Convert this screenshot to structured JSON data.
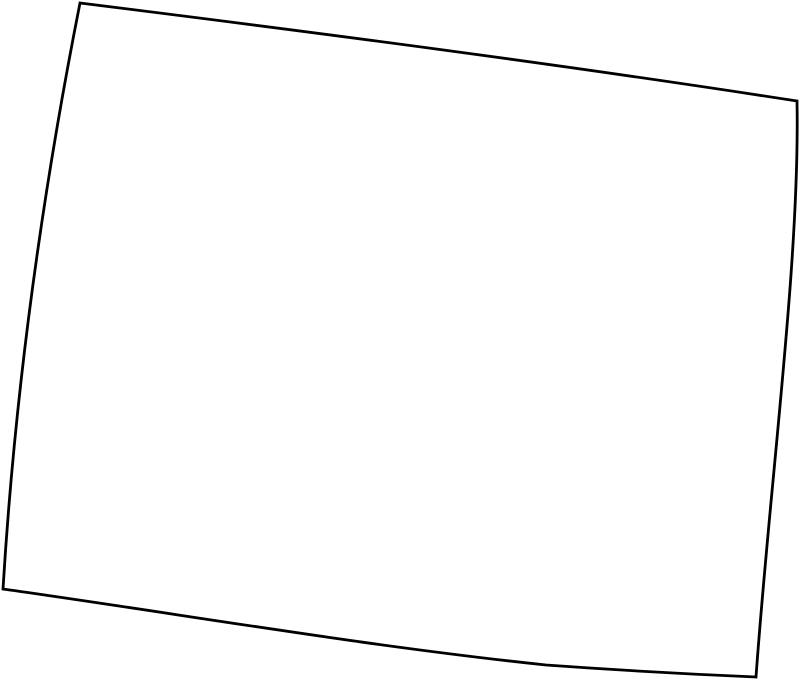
{
  "page": {
    "width": "800",
    "height": "683",
    "background_color": "#ffffff"
  },
  "map": {
    "kind": "blank-state-outline",
    "viewbox": "0 0 800 683",
    "stroke_color": "#000000",
    "fill_color": "#ffffff",
    "stroke_width": "2.8",
    "outline_path": "M 80,3 C 320,33 558,64 797,101 C 800,260 770,480 756,677 Q 650,672.5 546,665 C 365,646 184,614.5 3,589 C 15,390 42,195 80,3 Z",
    "corners": {
      "top_left": [
        80,
        3
      ],
      "top_right": [
        797,
        101
      ],
      "bottom_right": [
        756,
        677
      ],
      "bottom_left": [
        3,
        589
      ]
    }
  }
}
